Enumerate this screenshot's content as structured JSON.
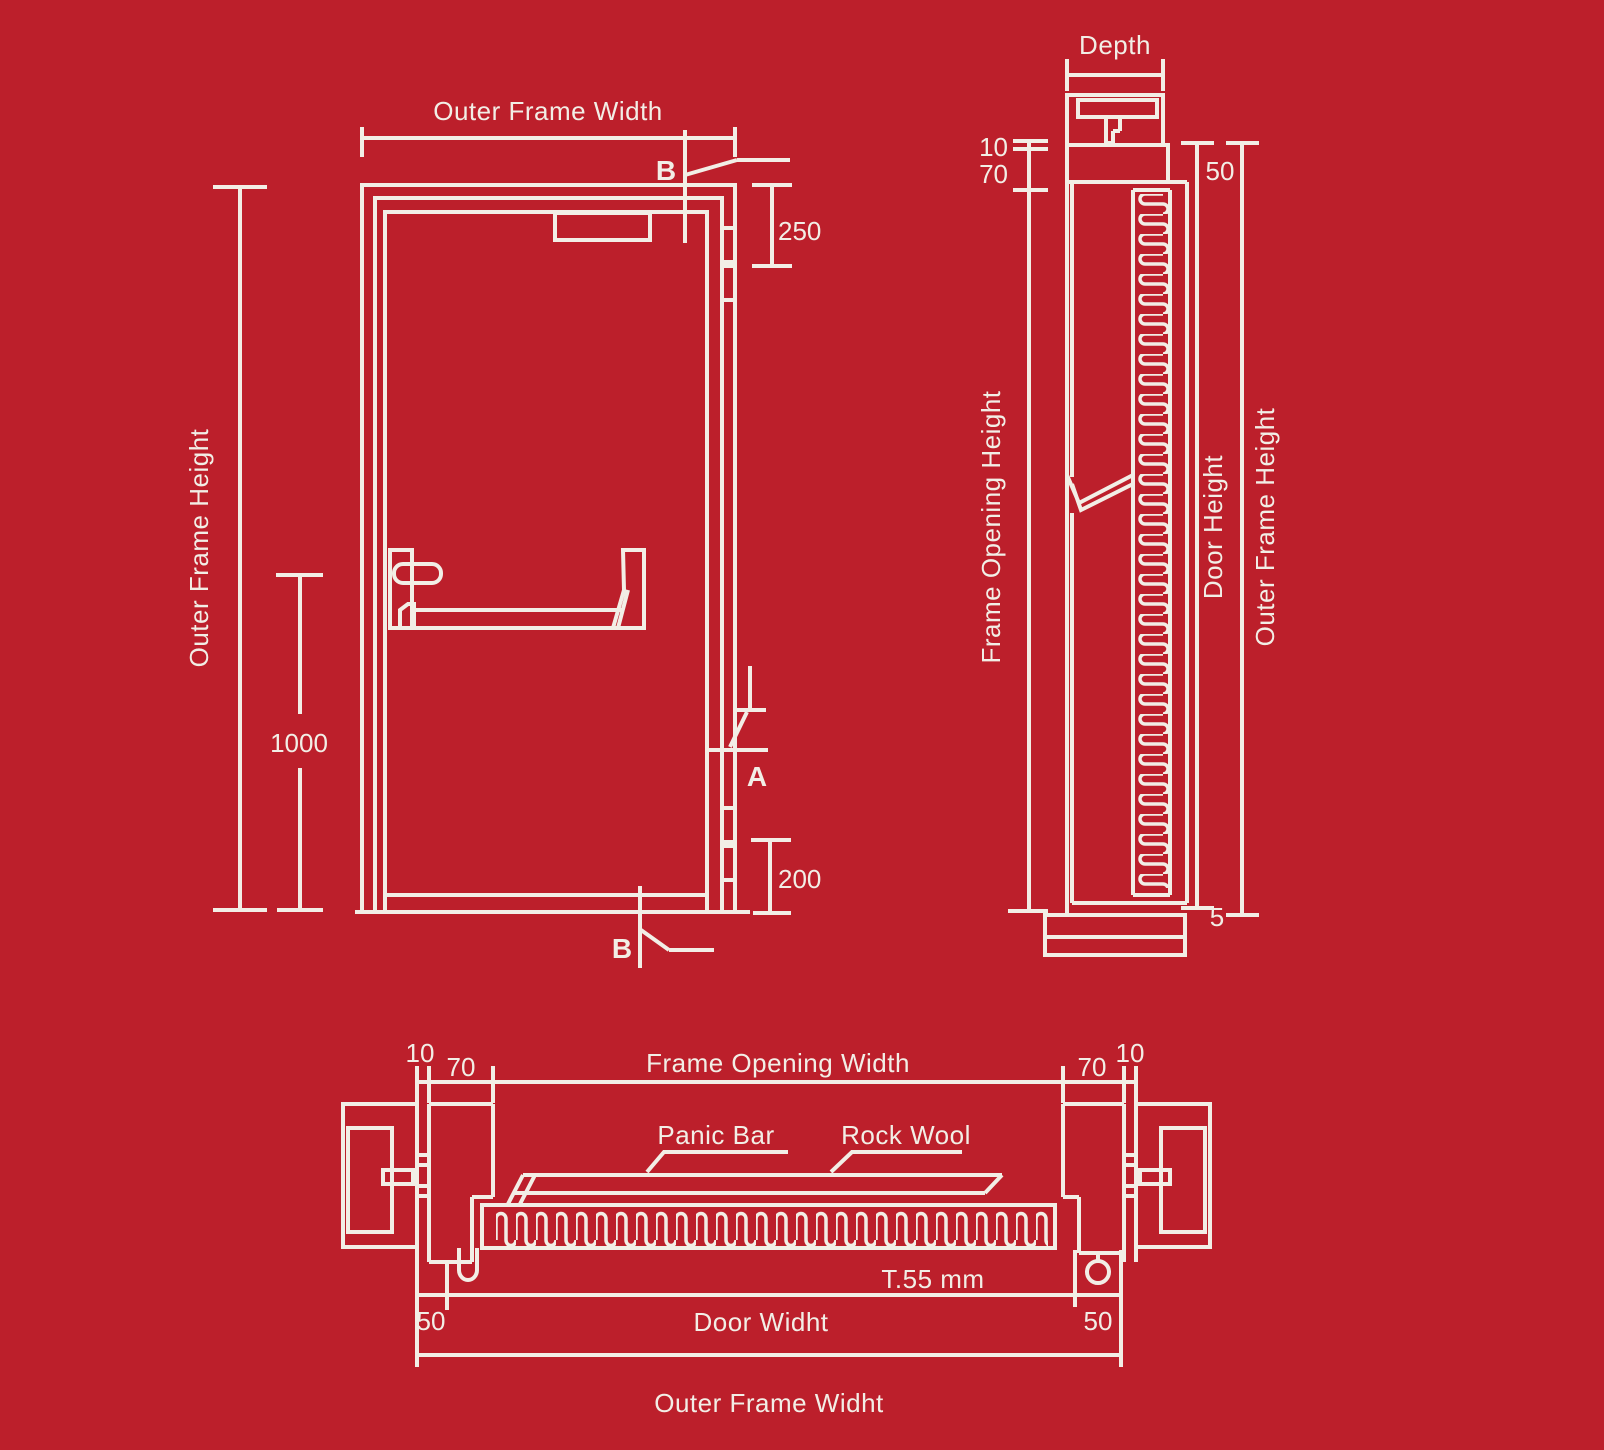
{
  "colors": {
    "background": "#BC1F2B",
    "line": "#F2EEE6"
  },
  "front_view": {
    "width_label": "Outer Frame Width",
    "height_label": "Outer Frame Height",
    "dim_1000": "1000",
    "dim_250": "250",
    "dim_200": "200",
    "mark_b_top": "B",
    "mark_b_bottom": "B",
    "mark_a": "A"
  },
  "side_view": {
    "depth_label": "Depth",
    "dim_10": "10",
    "dim_70": "70",
    "dim_50": "50",
    "frame_opening_height_label": "Frame Opening Height",
    "door_height_label": "Door Height",
    "outer_frame_height_label": "Outer Frame Height",
    "dim_5": "5"
  },
  "plan_view": {
    "dim_10_left": "10",
    "dim_70_left": "70",
    "opening_width_label": "Frame Opening Width",
    "dim_70_right": "70",
    "dim_10_right": "10",
    "panic_bar_label": "Panic Bar",
    "rock_wool_label": "Rock Wool",
    "thickness_label": "T.55 mm",
    "dim_50_left": "50",
    "door_width_label": "Door Widht",
    "dim_50_right": "50",
    "outer_width_label": "Outer Frame Widht"
  }
}
